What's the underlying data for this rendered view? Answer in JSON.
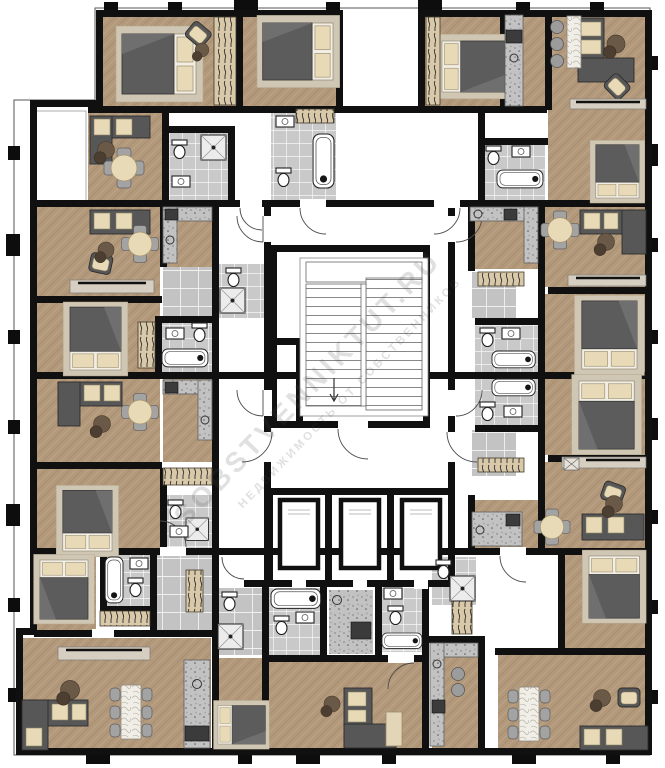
{
  "document": {
    "kind": "residential-floor-plan"
  },
  "watermark": {
    "line1": "SOBSTVENNIKTUT.RU",
    "line2": "НЕДВИЖИМОСТЬ ОТ СОБСТВЕННИКОВ"
  },
  "core": {
    "elevator_count": 3,
    "stair_flights": 2
  },
  "palette": {
    "page": "#ffffff",
    "wall": "#101010",
    "wood": "#b3997b",
    "tile": "#c9c9c9",
    "entry_tile": "#c3c3c3",
    "counter": "#c2c2c2",
    "rug": "#cfc6b4",
    "cushion": "#e8dab6",
    "furniture_dark": "#5c5c5c",
    "stove": "#3b3b3b",
    "wardrobe": "#d9c9a9",
    "pouf": "#6a5946",
    "watermark": "rgba(70,70,70,0.17)"
  }
}
